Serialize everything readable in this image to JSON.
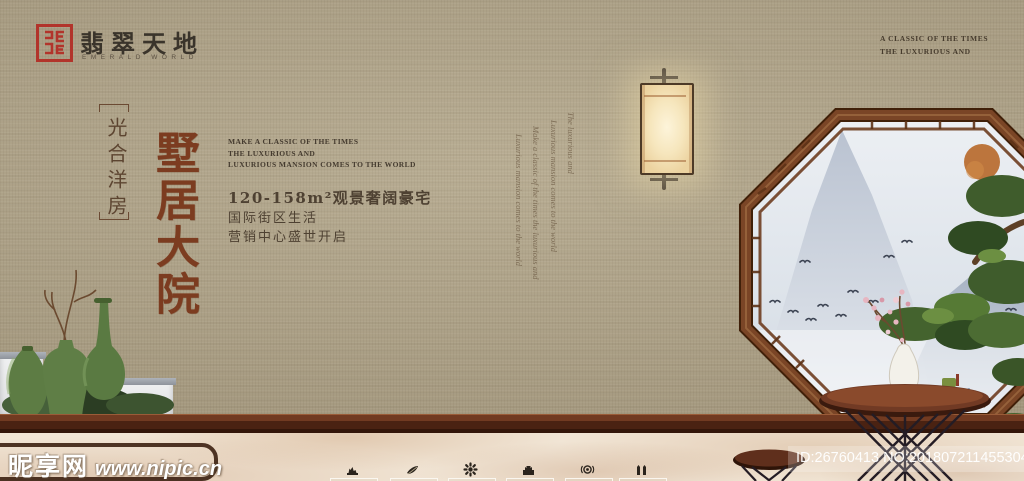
{
  "brand": {
    "name_cn": "翡翠天地",
    "name_en": "EMERALD WORLD",
    "seal_color": "#b2342b"
  },
  "top_right": {
    "line1": "A CLASSIC OF THE TIMES",
    "line2": "THE LUXURIOUS AND"
  },
  "left_column": {
    "bracket_text": "光合洋房",
    "headline": "墅居大院",
    "headline_color": "#7c3c20"
  },
  "intro": {
    "en_lines": [
      "MAKE A CLASSIC OF THE TIMES",
      "THE LUXURIOUS AND",
      "LUXURIOUS MANSION COMES TO THE WORLD"
    ],
    "cn_lines": [
      "120-158m²观景奢阔豪宅",
      "国际街区生活",
      "营销中心盛世开启"
    ]
  },
  "script_columns": [
    "Luxurious mansion comes to the world",
    "Make a classic of the times the luxurious and",
    "Luxurious mansion comes to the world",
    "The luxurious and"
  ],
  "watermark": {
    "site_cn": "昵享网",
    "site_url": "www.nipic.cn",
    "id_text": "ID:26760413 NO:20180721145530423000"
  },
  "icons": [
    {
      "name": "pavilion-icon"
    },
    {
      "name": "hand-leaf-icon"
    },
    {
      "name": "flower-icon"
    },
    {
      "name": "castle-icon"
    },
    {
      "name": "target-icon"
    },
    {
      "name": "twin-towers-icon"
    }
  ],
  "colors": {
    "wall": "#b1a58a",
    "window_frame": "#6e3b1f",
    "pine_green": "#45622f",
    "rail_wood": "#5d2e1a",
    "marble": "#f1e5d5",
    "vase_green": "#5d7c44",
    "lamp_glow": "#f6e6bd"
  }
}
